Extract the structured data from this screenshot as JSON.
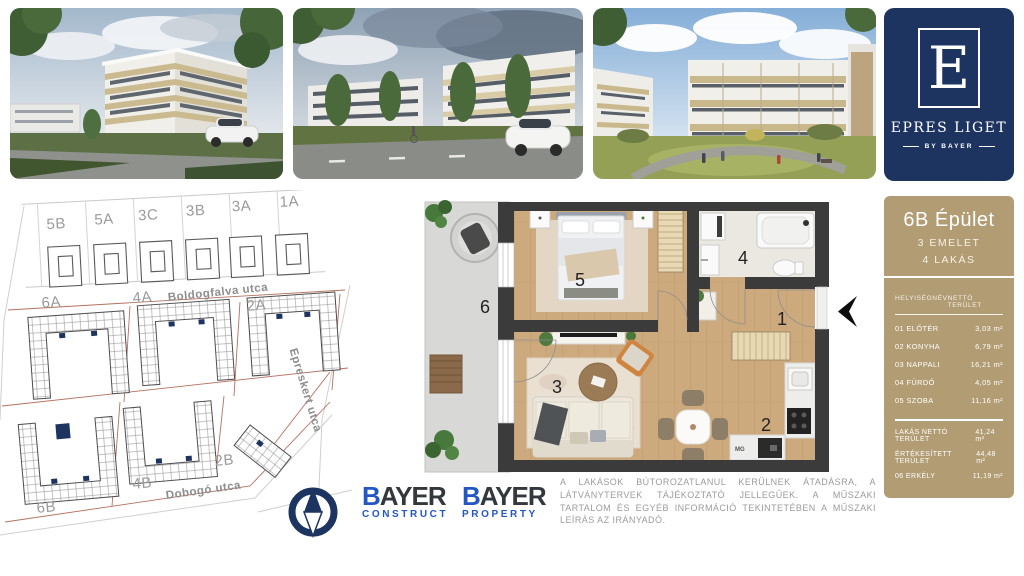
{
  "brand": {
    "logo_letter": "E",
    "logo_title": "EPRES LIGET",
    "logo_subtitle": "BY BAYER"
  },
  "site_map": {
    "parcels_top": [
      "5B",
      "5A",
      "3C",
      "3B",
      "3A",
      "1A"
    ],
    "blocks_middle": [
      "6A",
      "4A",
      "2A"
    ],
    "blocks_bottom": [
      "6B",
      "4B",
      "2B"
    ],
    "streets": {
      "north": "Boldogfalva utca",
      "east": "Epreskert utca",
      "south": "Dobogó utca"
    },
    "highlighted_block": "6B"
  },
  "floor_plan": {
    "rooms": {
      "entry": "1",
      "kitchen": "2",
      "living": "3",
      "bath": "4",
      "bedroom": "5",
      "balcony": "6"
    },
    "appliance_label": "MG"
  },
  "info_panel": {
    "building_title": "6B Épület",
    "floor_line": "3 EMELET",
    "units_line": "4 LAKÁS",
    "table": {
      "col_room": "HELYISÉGNÉV",
      "col_area": "NETTÓ TERÜLET",
      "rows": [
        {
          "name": "01 ELŐTÉR",
          "area": "3,03 m²"
        },
        {
          "name": "02 KONYHA",
          "area": "6,79 m²"
        },
        {
          "name": "03 NAPPALI",
          "area": "16,21 m²"
        },
        {
          "name": "04 FÜRDŐ",
          "area": "4,05 m²"
        },
        {
          "name": "05 SZOBA",
          "area": "11,16 m²"
        }
      ],
      "totals": [
        {
          "name": "LAKÁS NETTÓ TERÜLET",
          "area": "41,24 m²"
        },
        {
          "name": "ÉRTÉKESÍTETT TERÜLET",
          "area": "44,48 m²"
        },
        {
          "name": "06 ERKÉLY",
          "area": "11,19 m²"
        }
      ]
    }
  },
  "footer": {
    "logos": [
      {
        "brand_b": "B",
        "brand_rest": "AYER",
        "division": "CONSTRUCT"
      },
      {
        "brand_b": "B",
        "brand_rest": "AYER",
        "division": "PROPERTY"
      }
    ],
    "disclaimer": "A LAKÁSOK BÚTOROZATLANUL KERÜLNEK ÁTADÁSRA, A LÁTVÁNYTERVEK TÁJÉKOZTATÓ JELLEGŰEK. A MŰSZAKI TARTALOM ÉS EGYÉB INFORMÁCIÓ TEKINTETÉBEN A MŰSZAKI LEÍRÁS AZ IRÁNYADÓ."
  }
}
